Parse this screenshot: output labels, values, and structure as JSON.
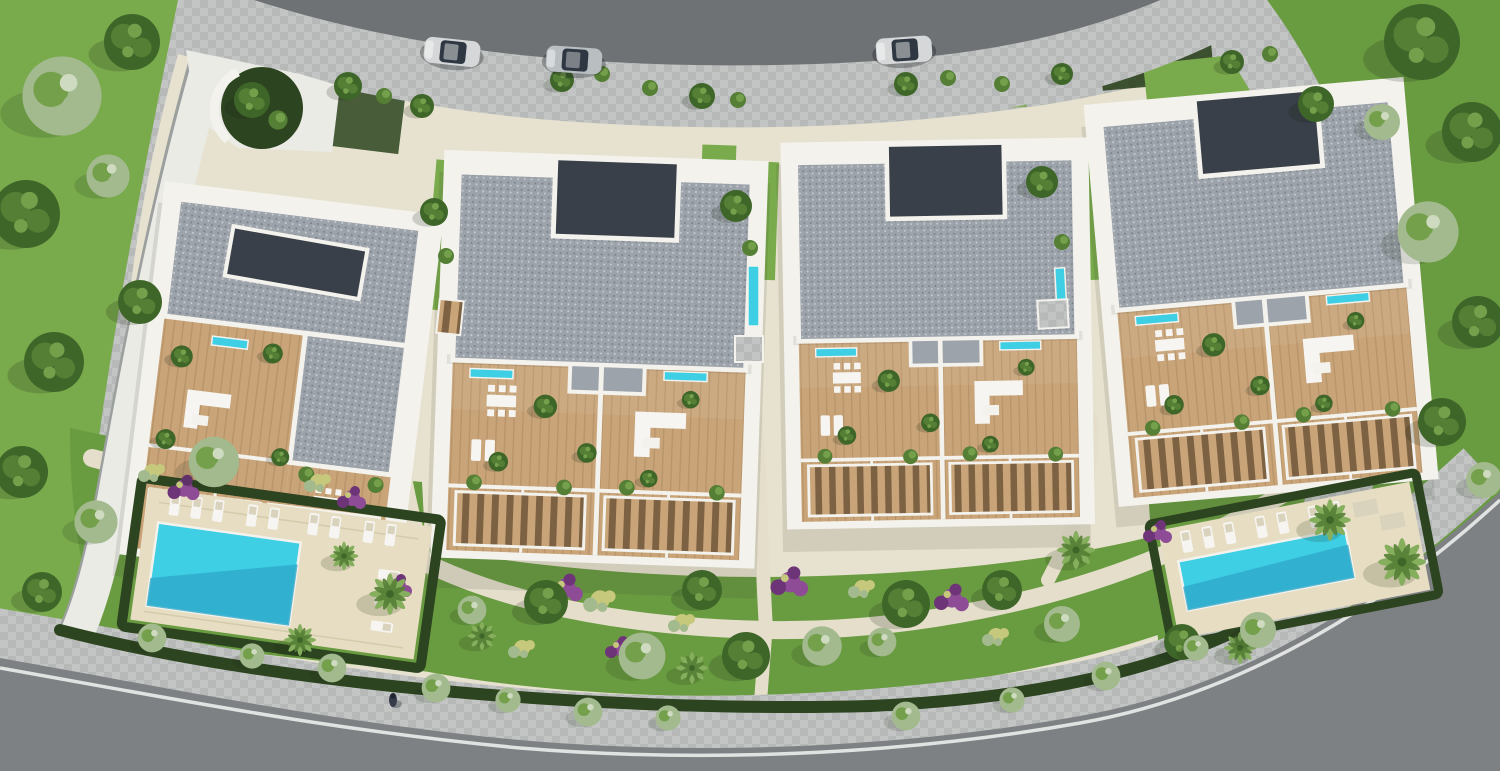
{
  "scene": {
    "kind": "aerial top-down 3D architectural render of a residential apartment complex",
    "apartment_buildings": 4,
    "building_features": [
      "grey gravel flat roofs with white parapets",
      "dark recessed roof courtyards",
      "timber terrace decks",
      "slatted pergolas",
      "terrace planting",
      "small plunge pools"
    ],
    "swimming_pools": 2,
    "sun_loungers_present": true,
    "cars_on_top_road": 3,
    "pedestrians_on_bottom_sidewalk": 1,
    "top_road": "curved asphalt road with white dashed center line",
    "bottom_road": "curved asphalt road with solid white edge line",
    "landscape": [
      "lawns",
      "palm trees",
      "clipped dark hedges",
      "purple and yellow flower beds",
      "beige garden paths",
      "street trees"
    ]
  },
  "palette": {
    "road": "#6e7275",
    "roadBottom": "#7e8183",
    "roadLine": "#e9ebea",
    "sidewalk": "#b6b9b8",
    "sidewalk2": "#c2c5c3",
    "curb": "#9b9f9e",
    "walkway": "#ebebe6",
    "platform": "#e7e2cf",
    "path": "#e4decb",
    "lawn": "#699b41",
    "lawnBright": "#79aa4c",
    "lawnShade": "#4c7a30",
    "hedge": "#2d4420",
    "treeDark": "#3f6629",
    "treeMid": "#557f35",
    "treeLight": "#74a04b",
    "sage": "#a3ba8e",
    "palm": "#85ae5d",
    "flowerPurple": "#8f4c96",
    "flowerPurpleDeep": "#6e3478",
    "flowerYellow": "#c6c87b",
    "roof": "#9da3ab",
    "roofSpeckle": "#868d97",
    "roofDark": "#3a4049",
    "wall": "#f3f2ed",
    "wood": "#c9a478",
    "woodDark": "#a9875e",
    "slatGap": "#7c6243",
    "deck": "#e6ddc2",
    "deckLine": "#d4cbac",
    "mat": "#d9d2bd",
    "pool": "#3ecfe4",
    "poolDeep": "#2fa7c9",
    "furniture": "#f6f5f1",
    "carSilver": "#d5d7d8",
    "carGrey": "#b9bec1",
    "glass": "#2f3842",
    "person": "#343c49"
  }
}
